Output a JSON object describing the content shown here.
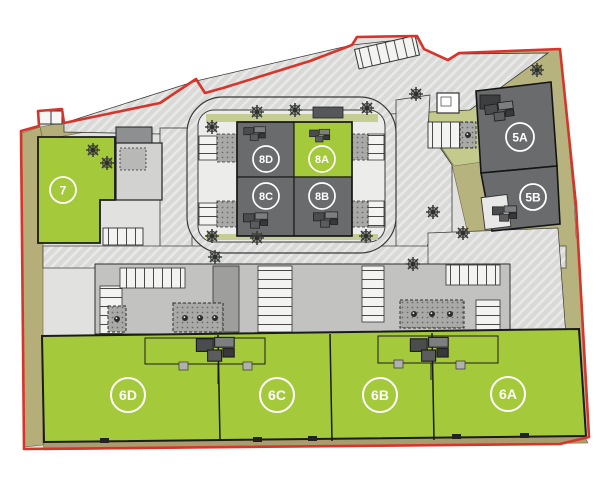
{
  "plan": {
    "name": "Industrial estate site plan",
    "boundary_color": "#d7352b",
    "available_color": "#a4c93b",
    "let_color": "#696b6d",
    "landscape_color": "#b7b37e",
    "road_color": "#d9d9d9"
  },
  "units": [
    {
      "id": "7",
      "label": "7",
      "status": "green"
    },
    {
      "id": "8D",
      "label": "8D",
      "status": "grey"
    },
    {
      "id": "8A",
      "label": "8A",
      "status": "green"
    },
    {
      "id": "8C",
      "label": "8C",
      "status": "grey"
    },
    {
      "id": "8B",
      "label": "8B",
      "status": "grey"
    },
    {
      "id": "5A",
      "label": "5A",
      "status": "grey"
    },
    {
      "id": "5B",
      "label": "5B",
      "status": "grey"
    },
    {
      "id": "6D",
      "label": "6D",
      "status": "green"
    },
    {
      "id": "6C",
      "label": "6C",
      "status": "green"
    },
    {
      "id": "6B",
      "label": "6B",
      "status": "green"
    },
    {
      "id": "6A",
      "label": "6A",
      "status": "green"
    }
  ]
}
